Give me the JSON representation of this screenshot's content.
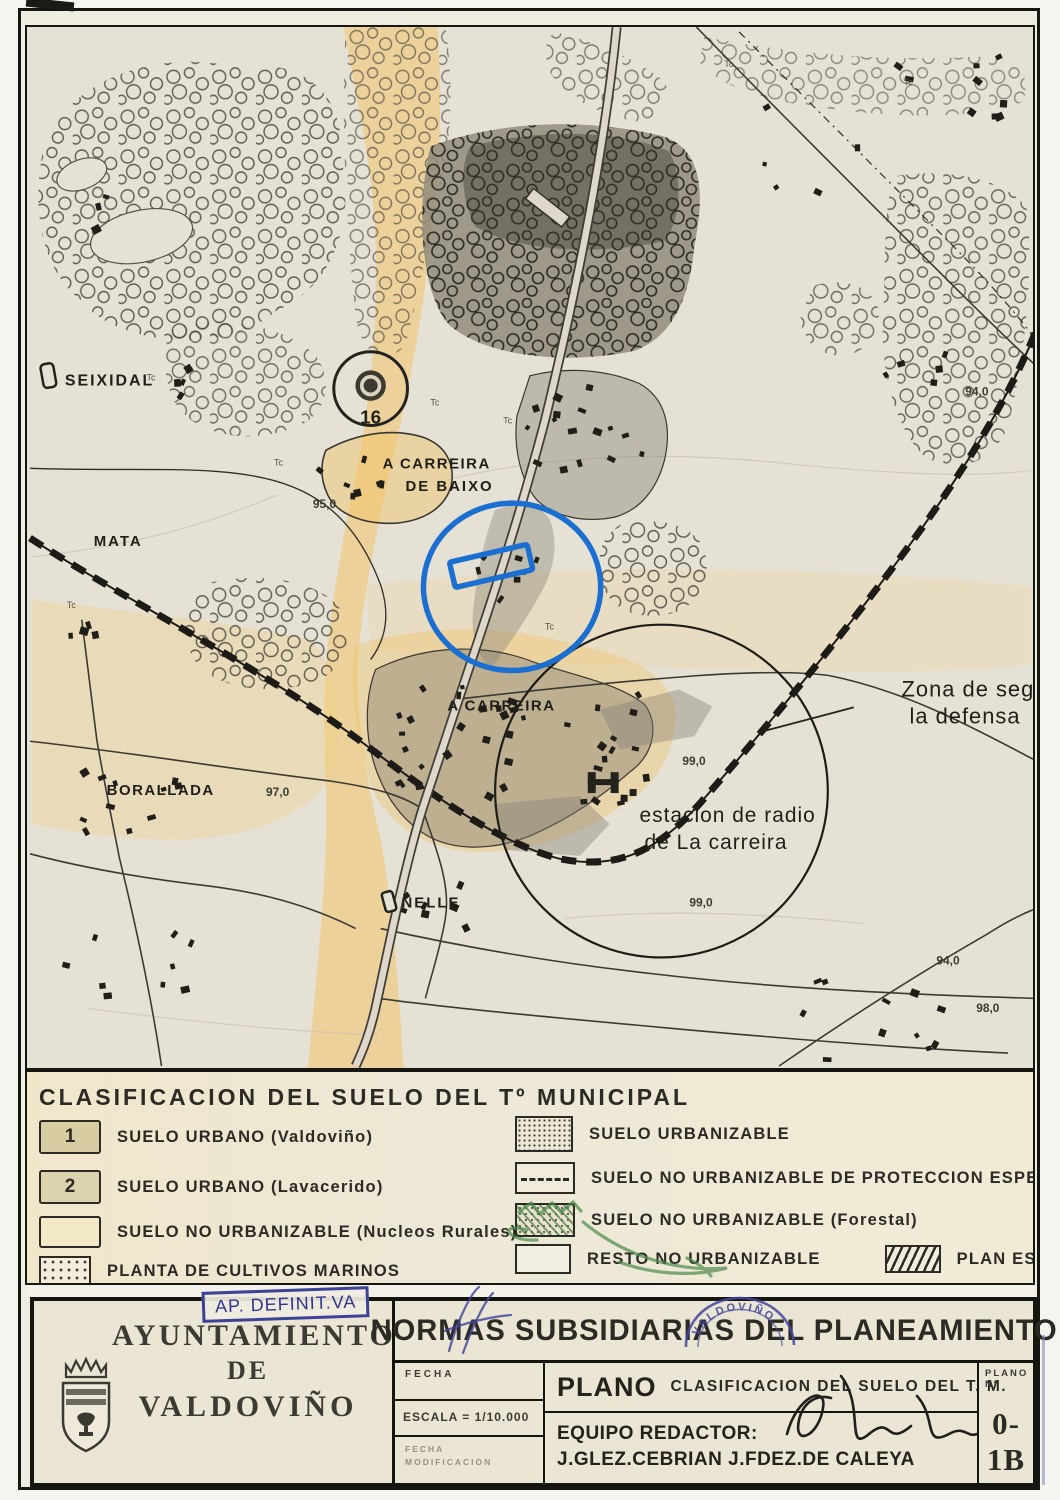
{
  "colors": {
    "annotation_blue": "#1b6fd0",
    "stamp_blue": "#3d43a0",
    "pen_green": "#4c8a4c",
    "rural_orange": "#f0bf74"
  },
  "map": {
    "labels": {
      "seixidal": "SEIXIDAL",
      "mata": "MATA",
      "carreira_baixo_line1": "A CARREIRA",
      "carreira_baixo_line2": "DE BAIXO",
      "carreira": "A CARREIRA",
      "borallada": "BORALLADA",
      "nelle": "NELLE",
      "estacion_line1": "estacion de radio",
      "estacion_line2": "de La carreira",
      "zona_line1": "Zona de seg",
      "zona_line2": "la defensa",
      "marker_16": "16",
      "tc": "Tc"
    },
    "elevations": {
      "e1": "95,0",
      "e2": "97,0",
      "e3": "99,0",
      "e4": "99,0",
      "e5": "94,0",
      "e6": "98,0",
      "e7": "94,0"
    }
  },
  "legend": {
    "title": "CLASIFICACION DEL SUELO DEL Tº MUNICIPAL",
    "left": [
      {
        "key": "1",
        "label": "SUELO URBANO (Valdoviño)"
      },
      {
        "key": "2",
        "label": "SUELO URBANO (Lavacerido)"
      },
      {
        "key": "",
        "label": "SUELO NO URBANIZABLE (Nucleos Rurales)"
      },
      {
        "key": "",
        "label": "PLANTA DE CULTIVOS MARINOS"
      }
    ],
    "right": [
      {
        "label": "SUELO URBANIZABLE"
      },
      {
        "label": "SUELO NO URBANIZABLE DE PROTECCION ESPECIAL"
      },
      {
        "label": "SUELO NO URBANIZABLE (Forestal)"
      },
      {
        "label": "RESTO NO URBANIZABLE"
      },
      {
        "label": "PLAN ESPECIAL"
      }
    ]
  },
  "titleblock": {
    "approval_stamp": "AP. DEFINIT.VA",
    "org_line1": "AYUNTAMIENTO",
    "org_line2": "DE",
    "org_line3": "VALDOVIÑO",
    "main_title": "NORMAS SUBSIDIARIAS DEL PLANEAMIENTO",
    "fecha_label": "FECHA",
    "escala_label": "ESCALA = 1/10.000",
    "fecha_mod_line1": "FECHA",
    "fecha_mod_line2": "MODIFICACION",
    "plano_label": "PLANO",
    "plano_value": "CLASIFICACION DEL SUELO DEL T. M.",
    "equipo_label": "EQUIPO REDACTOR:",
    "equipo_value": "J.GLEZ.CEBRIAN  J.FDEZ.DE CALEYA",
    "plano_num_label": "PLANO Nº",
    "plano_num_value": "0-1B",
    "round_stamp": "VALDOVIÑO"
  }
}
